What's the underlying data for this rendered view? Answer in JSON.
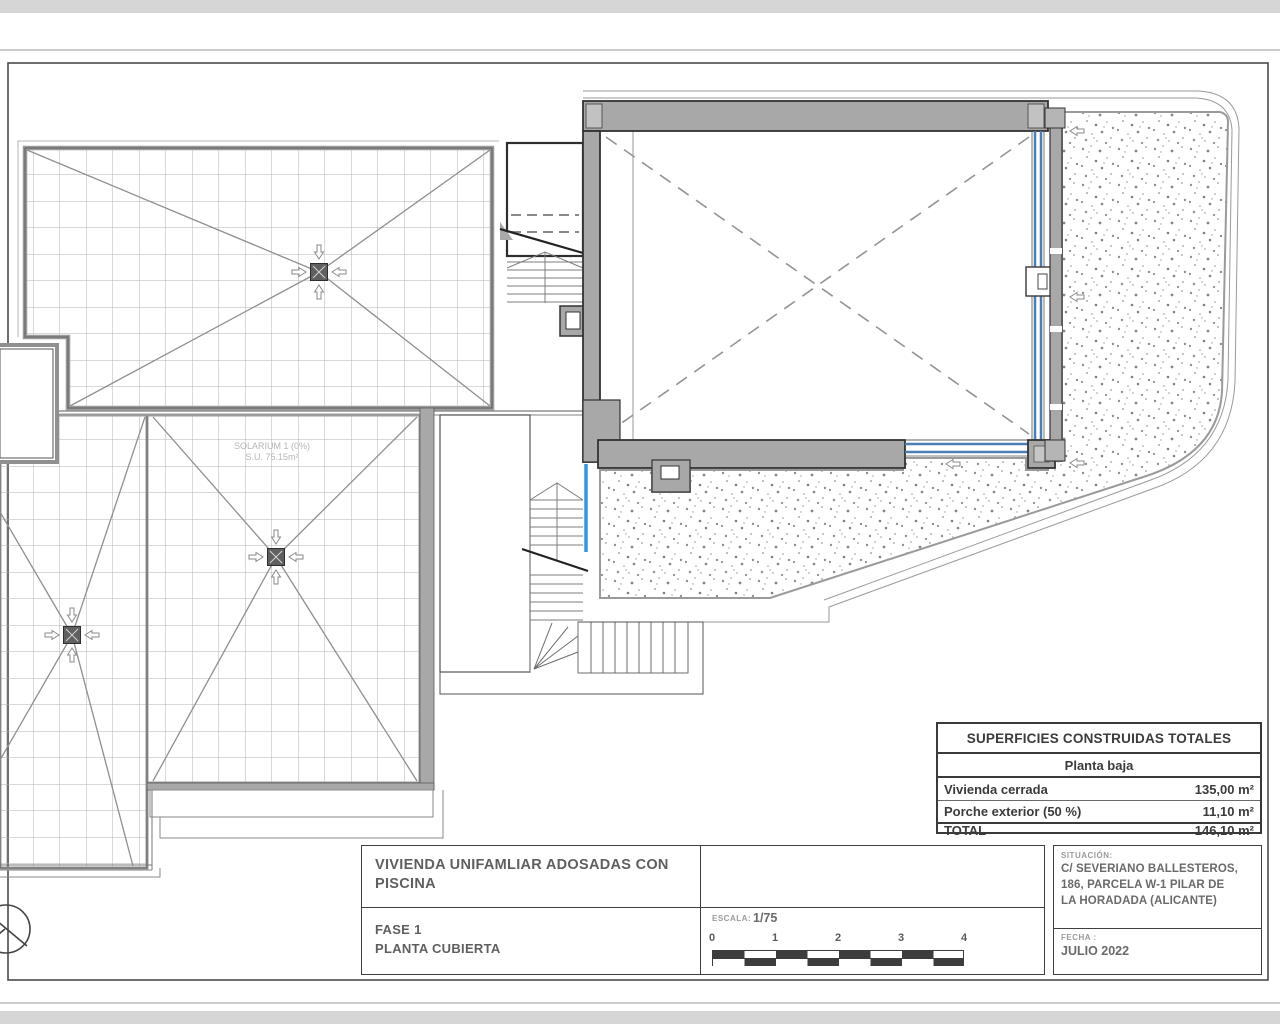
{
  "drawing": {
    "solarium_label": "SOLARIUM 1 (0%)",
    "solarium_area": "S.U. 75.15m²"
  },
  "areas_table": {
    "title": "SUPERFICIES CONSTRUIDAS TOTALES",
    "floor": "Planta baja",
    "rows": [
      {
        "label": "Vivienda cerrada",
        "value": "135,00 m²"
      },
      {
        "label": "Porche exterior (50 %)",
        "value": "11,10 m²"
      },
      {
        "label": "TOTAL",
        "value": "146,10 m²"
      }
    ]
  },
  "title_block": {
    "project": "VIVIENDA UNIFAMLIAR ADOSADAS CON PISCINA",
    "phase": "FASE 1",
    "sheet": "PLANTA CUBIERTA",
    "scale_label": "ESCALA:",
    "scale_value": "1/75",
    "scale_ticks": [
      "0",
      "1",
      "2",
      "3",
      "4"
    ],
    "location_label": "SITUACIÓN:",
    "location_line1": "C/ SEVERIANO BALLESTEROS,",
    "location_line2": "186, PARCELA W-1 PILAR DE",
    "location_line3": "LA HORADADA (ALICANTE)",
    "date_label": "FECHA :",
    "date_value": "JULIO 2022"
  },
  "colors": {
    "wall_gray": "#a6a6a6",
    "glazing_blue": "#4a7fb5",
    "stair_blue": "#2f96e8",
    "line_dark": "#3a3a3a",
    "grid_gray": "#b3b3b3"
  }
}
